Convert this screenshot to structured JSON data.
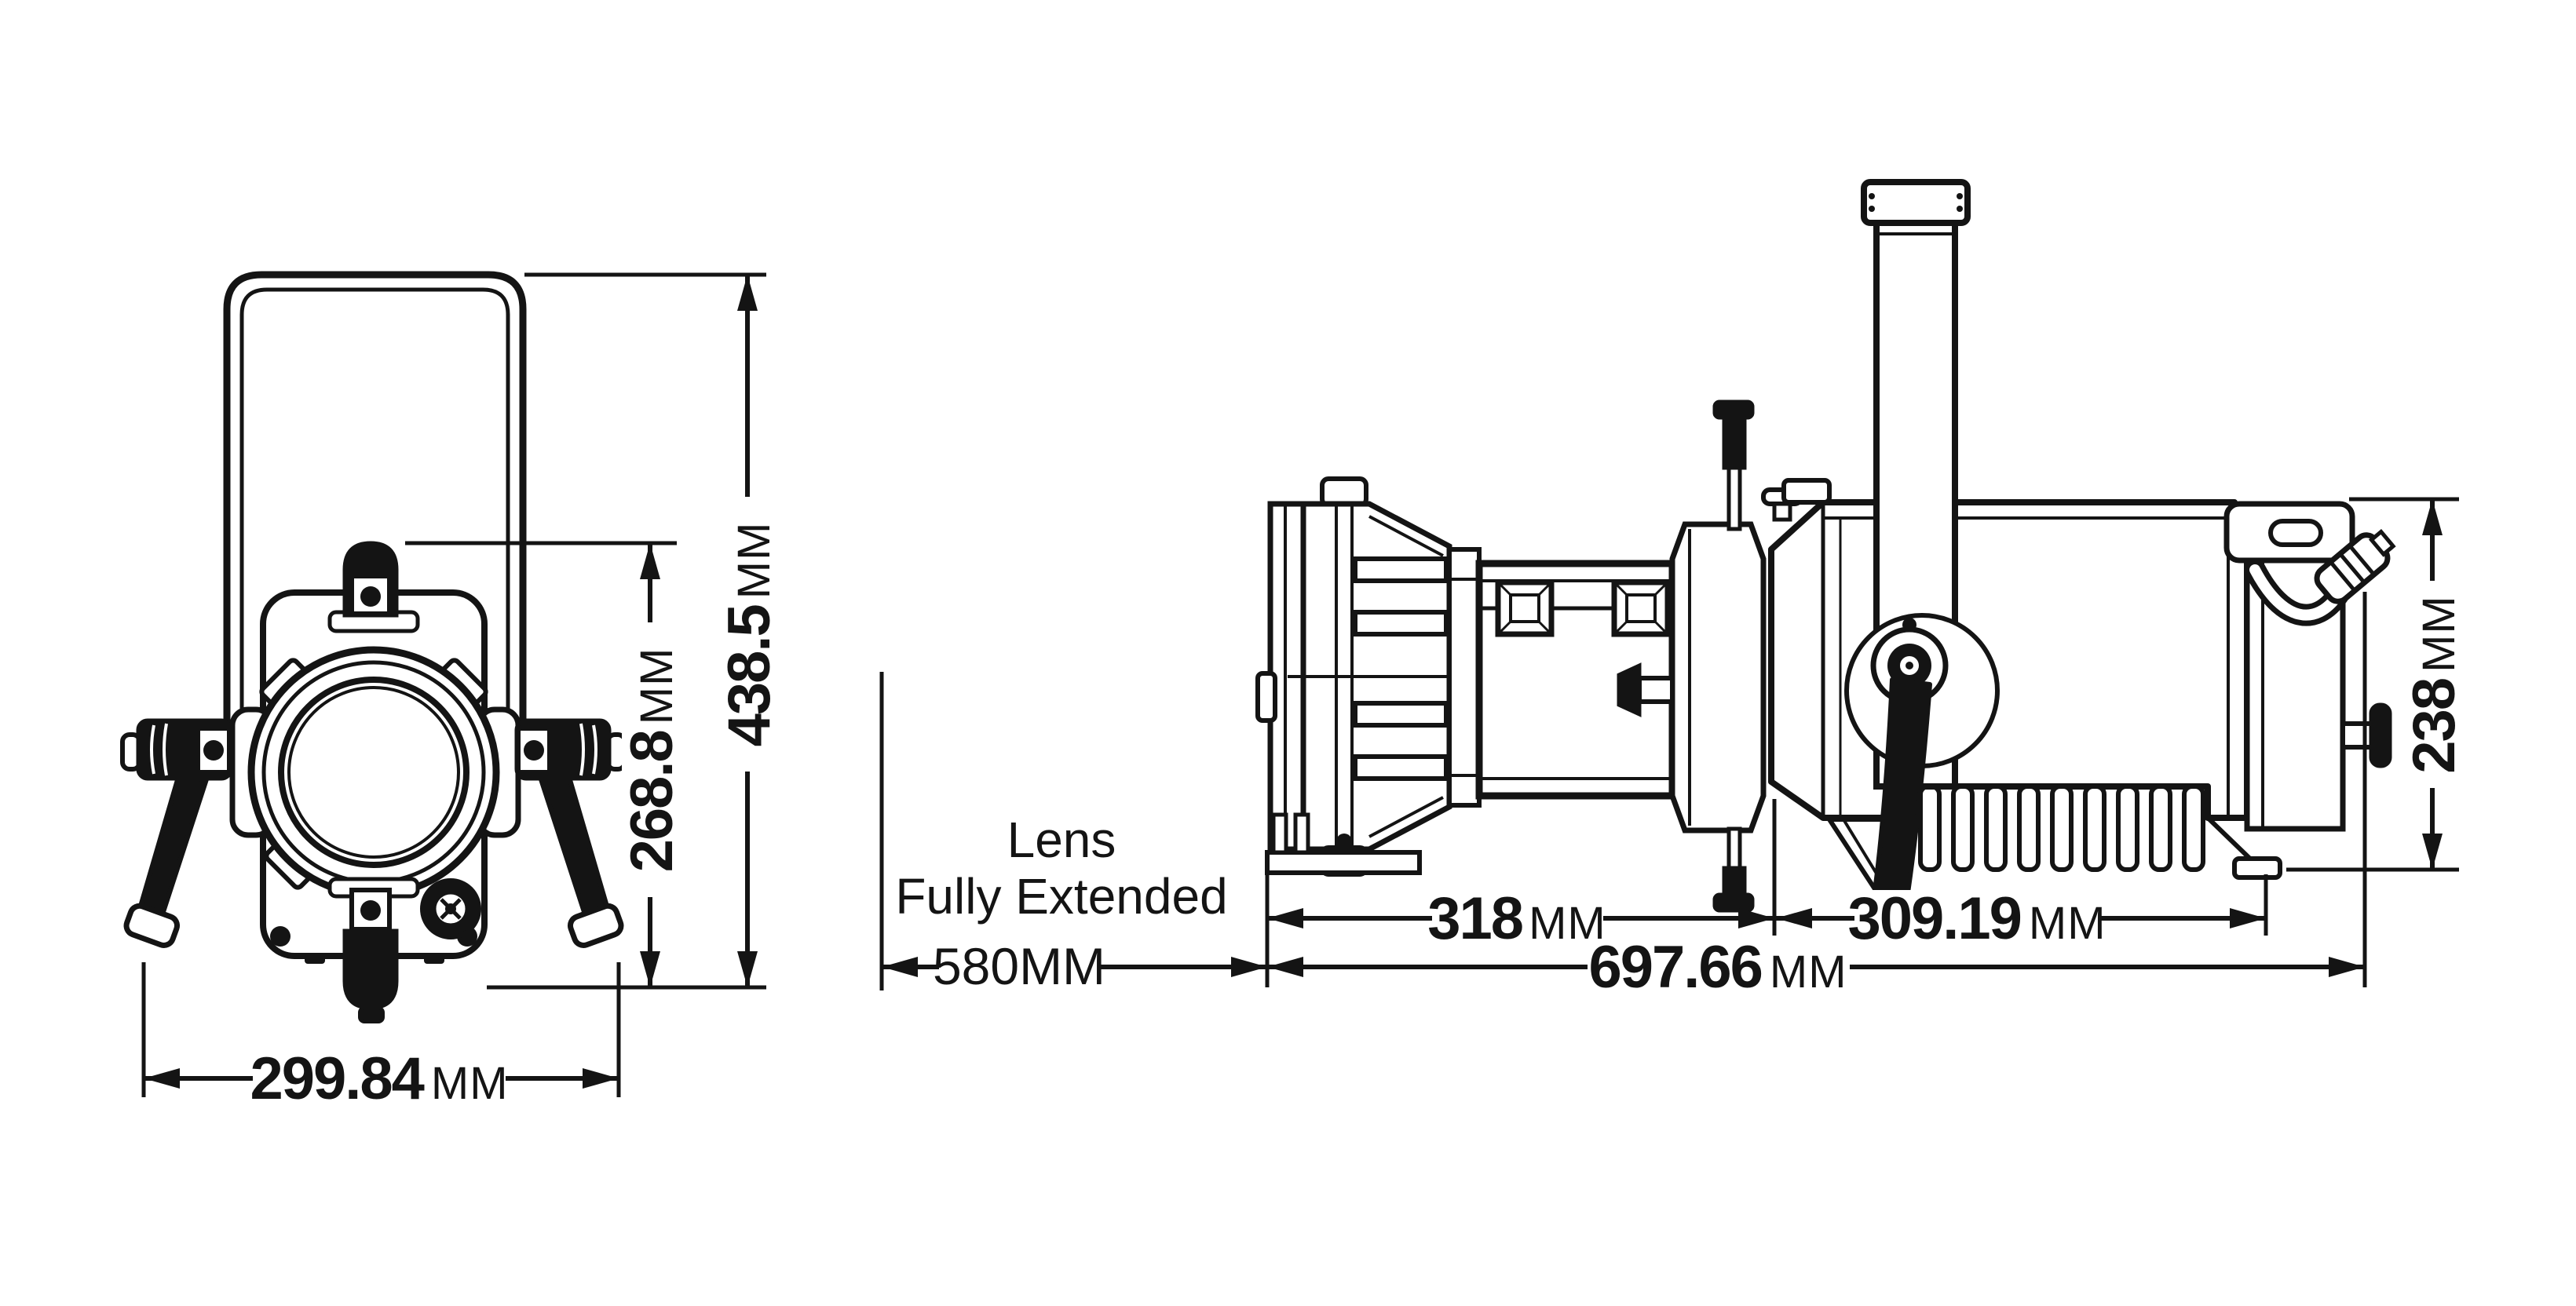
{
  "page": {
    "background": "#ffffff",
    "ink": "#141414",
    "description_visible_text_only": true
  },
  "annotation": {
    "line1": "Lens",
    "line2": "Fully Extended"
  },
  "dimensions": {
    "front_overall_height": {
      "value": "438.5",
      "unit": "MM"
    },
    "front_body_height": {
      "value": "268.8",
      "unit": "MM"
    },
    "front_overall_width": {
      "value": "299.84",
      "unit": "MM"
    },
    "side_front_length": {
      "value": "318",
      "unit": "MM"
    },
    "side_rear_length": {
      "value": "309.19",
      "unit": "MM"
    },
    "side_overall_length": {
      "value": "697.66",
      "unit": "MM"
    },
    "side_body_height": {
      "value": "238",
      "unit": "MM"
    },
    "side_extended_length": {
      "value": "580",
      "unit": "MM"
    }
  }
}
